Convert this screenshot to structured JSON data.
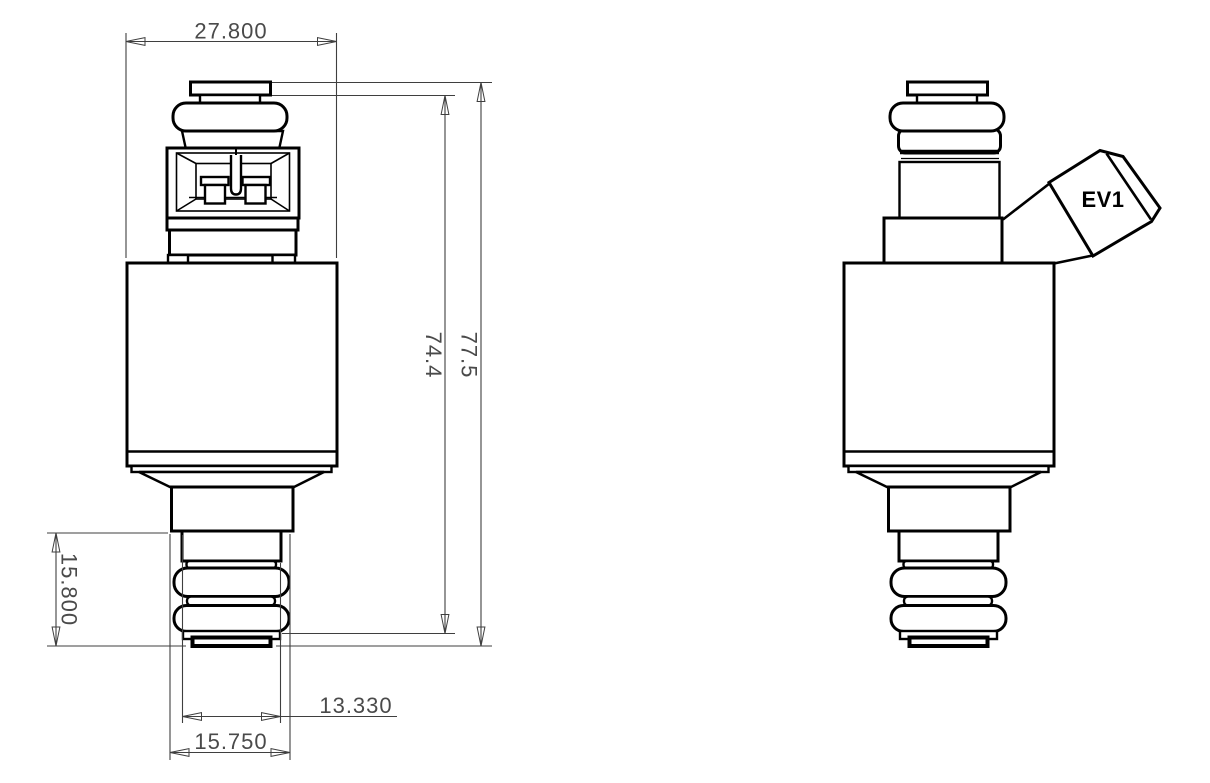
{
  "colors": {
    "background": "#ffffff",
    "geometry": "#000000",
    "dimension_lines": "#3f3f3f",
    "dimension_text": "#4a4a4a"
  },
  "dimensions": {
    "body_width": "27.800",
    "cap_to_seat_height": "74.4",
    "overall_height": "77.5",
    "lower_tip_height": "15.800",
    "tip_width": "13.330",
    "seat_width": "15.750"
  },
  "labels": {
    "connector_type": "EV1"
  }
}
